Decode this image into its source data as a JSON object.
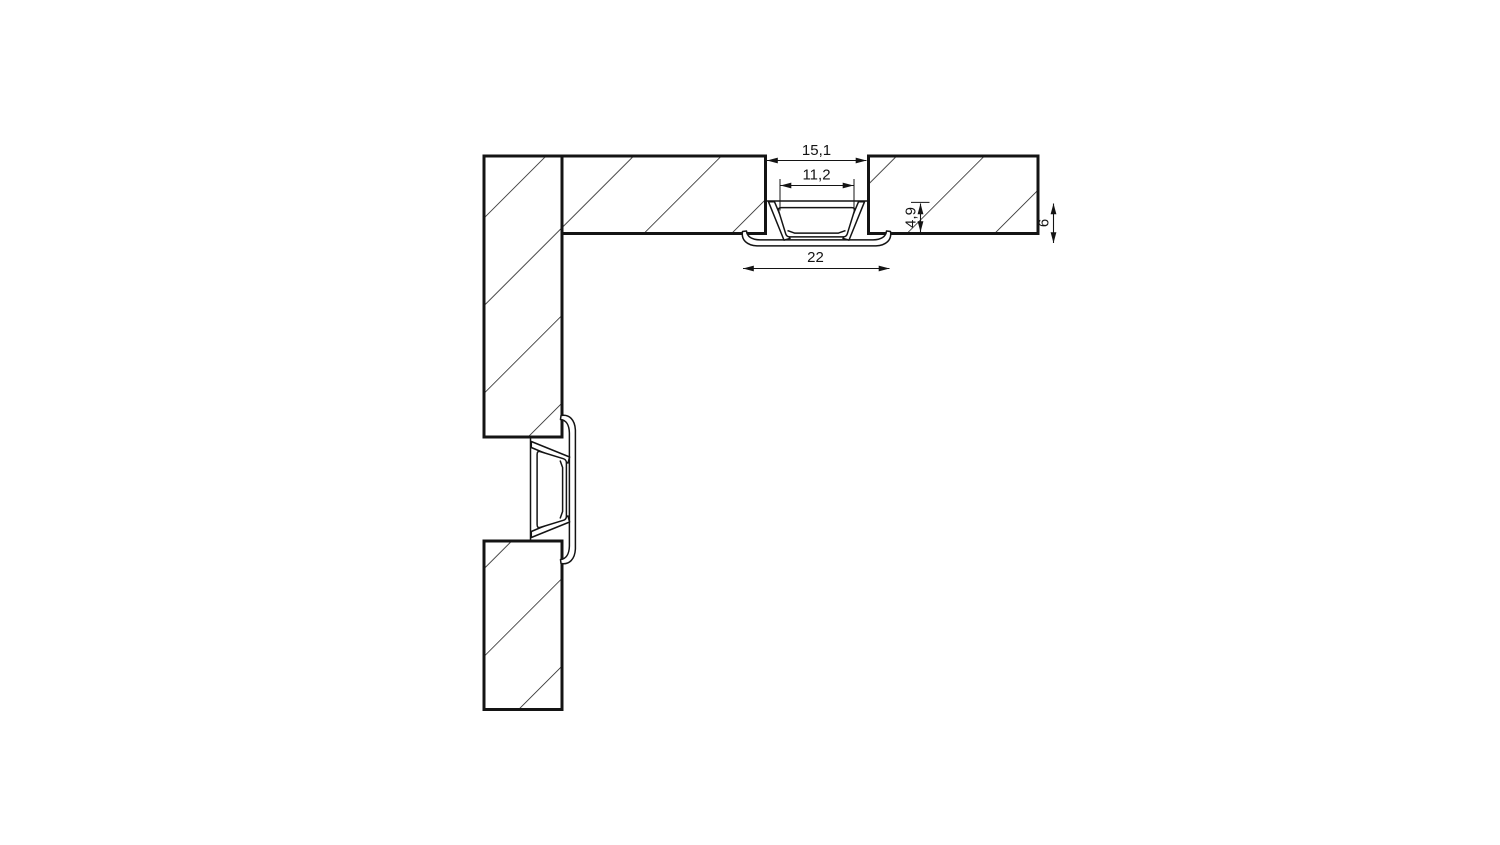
{
  "diagram": {
    "dimensions": {
      "cutout_width": "15,1",
      "cover_visible_width": "11,2",
      "overall_flange_width": "22",
      "recess_depth": "4,9",
      "profile_height": "6"
    },
    "colors": {
      "ink": "#141414",
      "background": "#ffffff"
    }
  }
}
